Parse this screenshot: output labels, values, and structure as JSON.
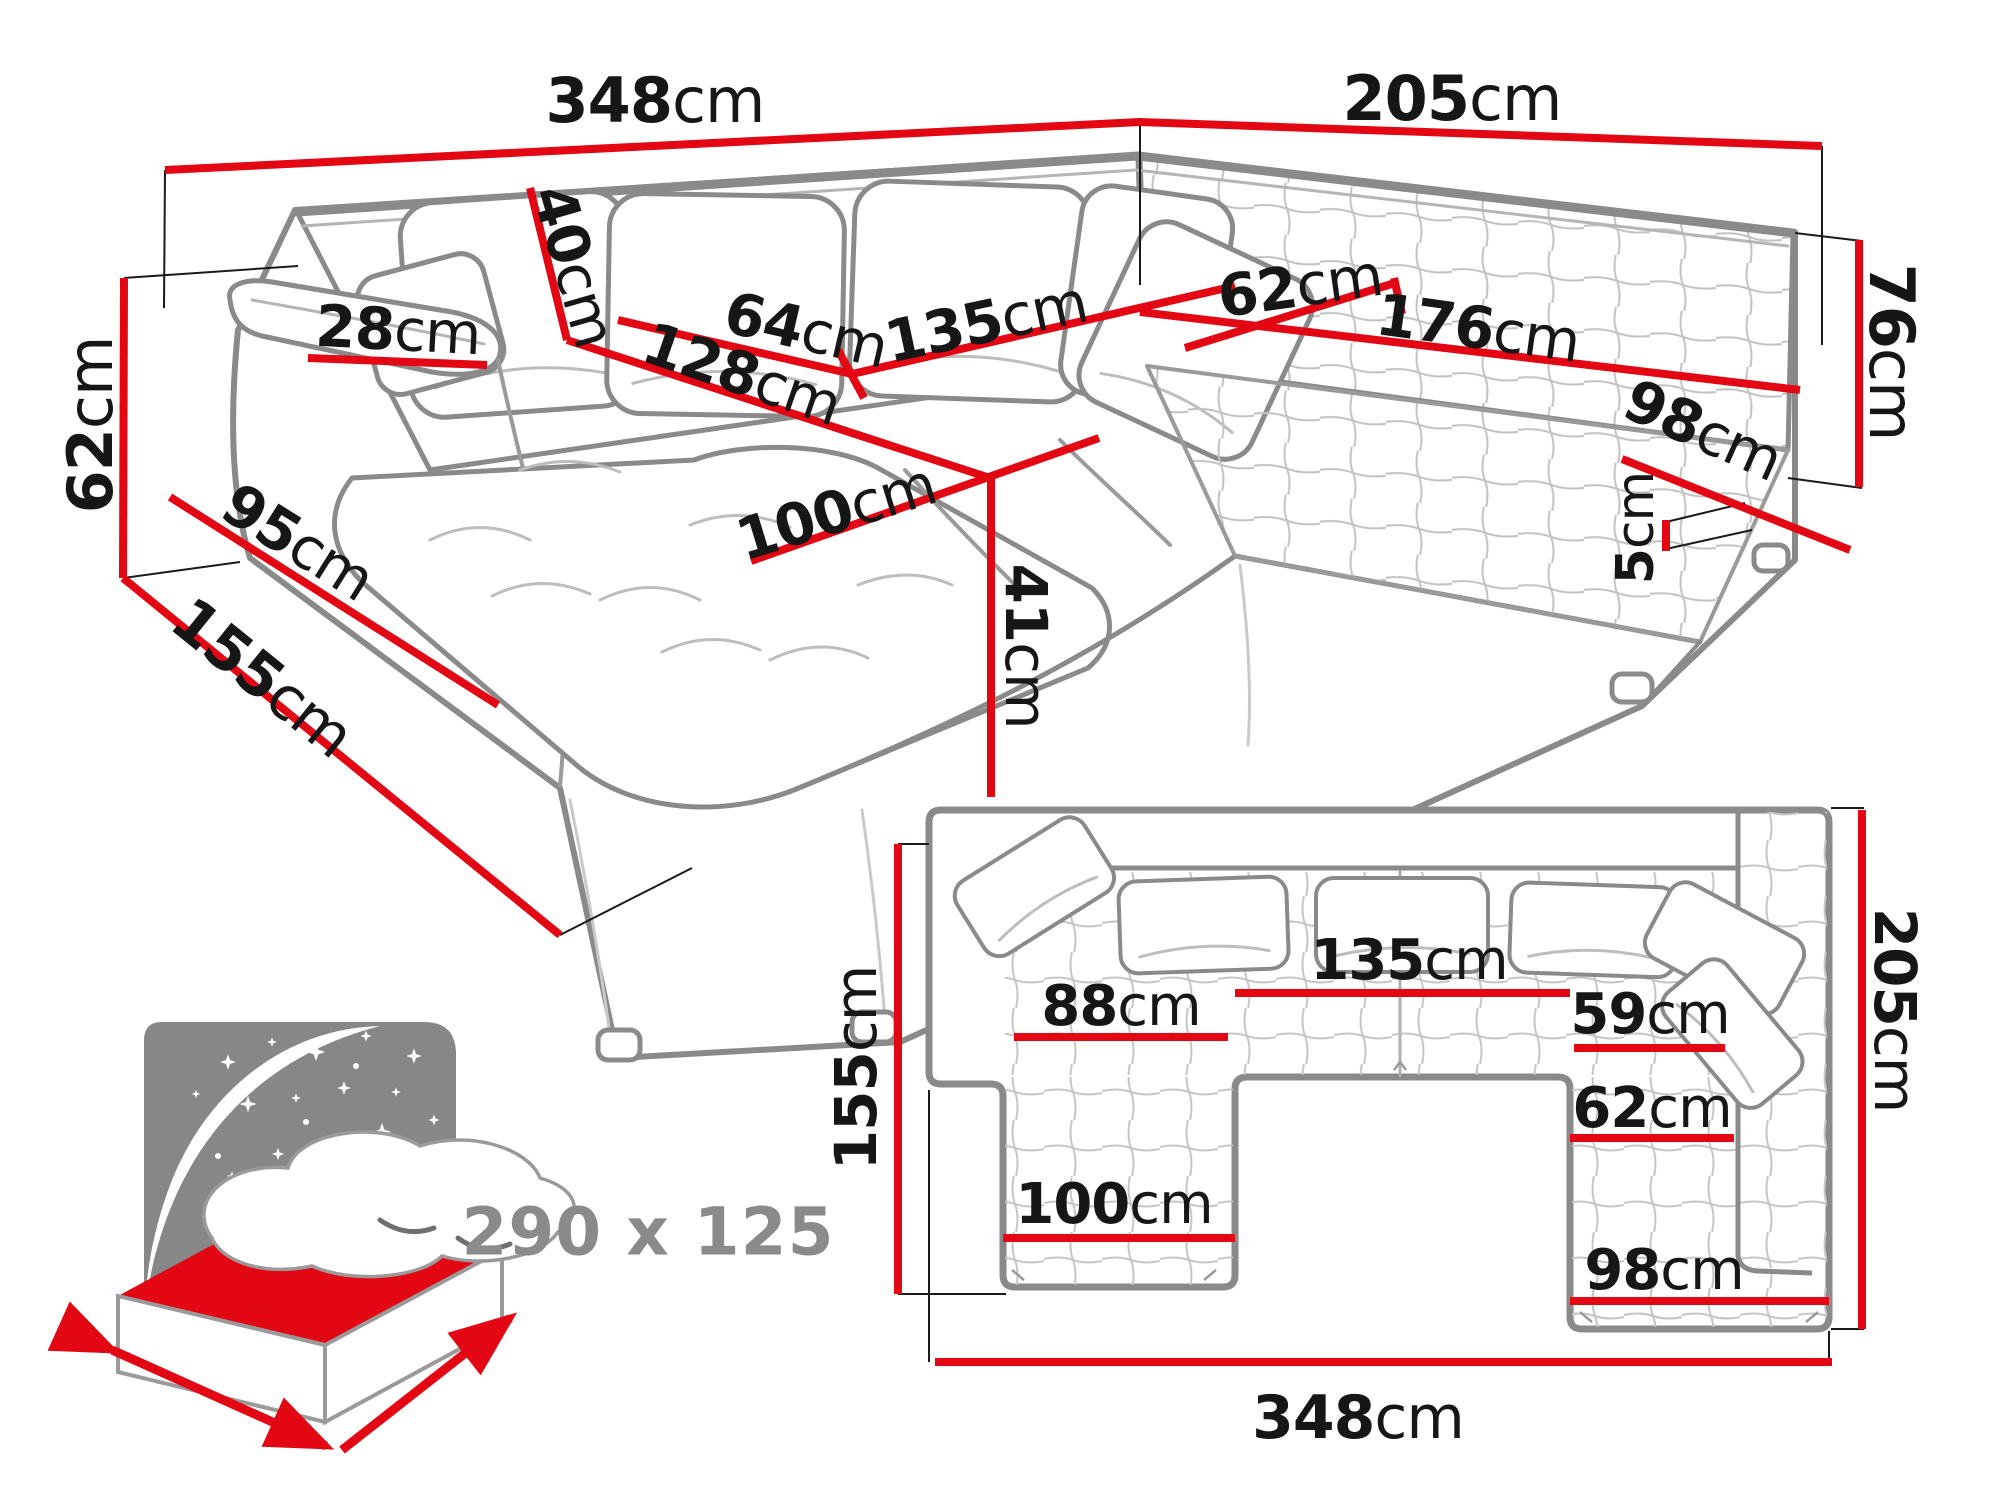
{
  "title": "U-shaped corner sofa dimension diagram",
  "colors": {
    "dimension_red": "#e30613",
    "sketch_gray": "#8a8a8a",
    "sketch_light_gray": "#bdbdbd",
    "label_black": "#161616",
    "icon_gray": "#8a8a8a",
    "background": "#ffffff"
  },
  "perspective_view": {
    "dims": {
      "back_width": {
        "num": "348",
        "unit": "cm"
      },
      "right_width": {
        "num": "205",
        "unit": "cm"
      },
      "backrest_height": {
        "num": "76",
        "unit": "cm"
      },
      "armrest_height": {
        "num": "62",
        "unit": "cm"
      },
      "chaise_length": {
        "num": "155",
        "unit": "cm"
      },
      "side_depth": {
        "num": "95",
        "unit": "cm"
      },
      "armrest_width": {
        "num": "28",
        "unit": "cm"
      },
      "cushion_height": {
        "num": "40",
        "unit": "cm"
      },
      "seat_depth": {
        "num": "64",
        "unit": "cm"
      },
      "middle_width": {
        "num": "135",
        "unit": "cm"
      },
      "chaise_run": {
        "num": "128",
        "unit": "cm"
      },
      "chaise_width": {
        "num": "100",
        "unit": "cm"
      },
      "seat_height": {
        "num": "41",
        "unit": "cm"
      },
      "corner_depth": {
        "num": "62",
        "unit": "cm"
      },
      "right_seat_width": {
        "num": "176",
        "unit": "cm"
      },
      "right_end_width": {
        "num": "98",
        "unit": "cm"
      },
      "leg_height": {
        "num": "5",
        "unit": "cm"
      }
    }
  },
  "top_view": {
    "dims": {
      "left_length": {
        "num": "155",
        "unit": "cm"
      },
      "seat_88": {
        "num": "88",
        "unit": "cm"
      },
      "seat_135": {
        "num": "135",
        "unit": "cm"
      },
      "seat_59": {
        "num": "59",
        "unit": "cm"
      },
      "seat_62": {
        "num": "62",
        "unit": "cm"
      },
      "seat_100": {
        "num": "100",
        "unit": "cm"
      },
      "seat_98": {
        "num": "98",
        "unit": "cm"
      },
      "right_length": {
        "num": "205",
        "unit": "cm"
      },
      "total_width": {
        "num": "348",
        "unit": "cm"
      }
    }
  },
  "sleeping_function": {
    "bed_size": "290 x 125"
  }
}
